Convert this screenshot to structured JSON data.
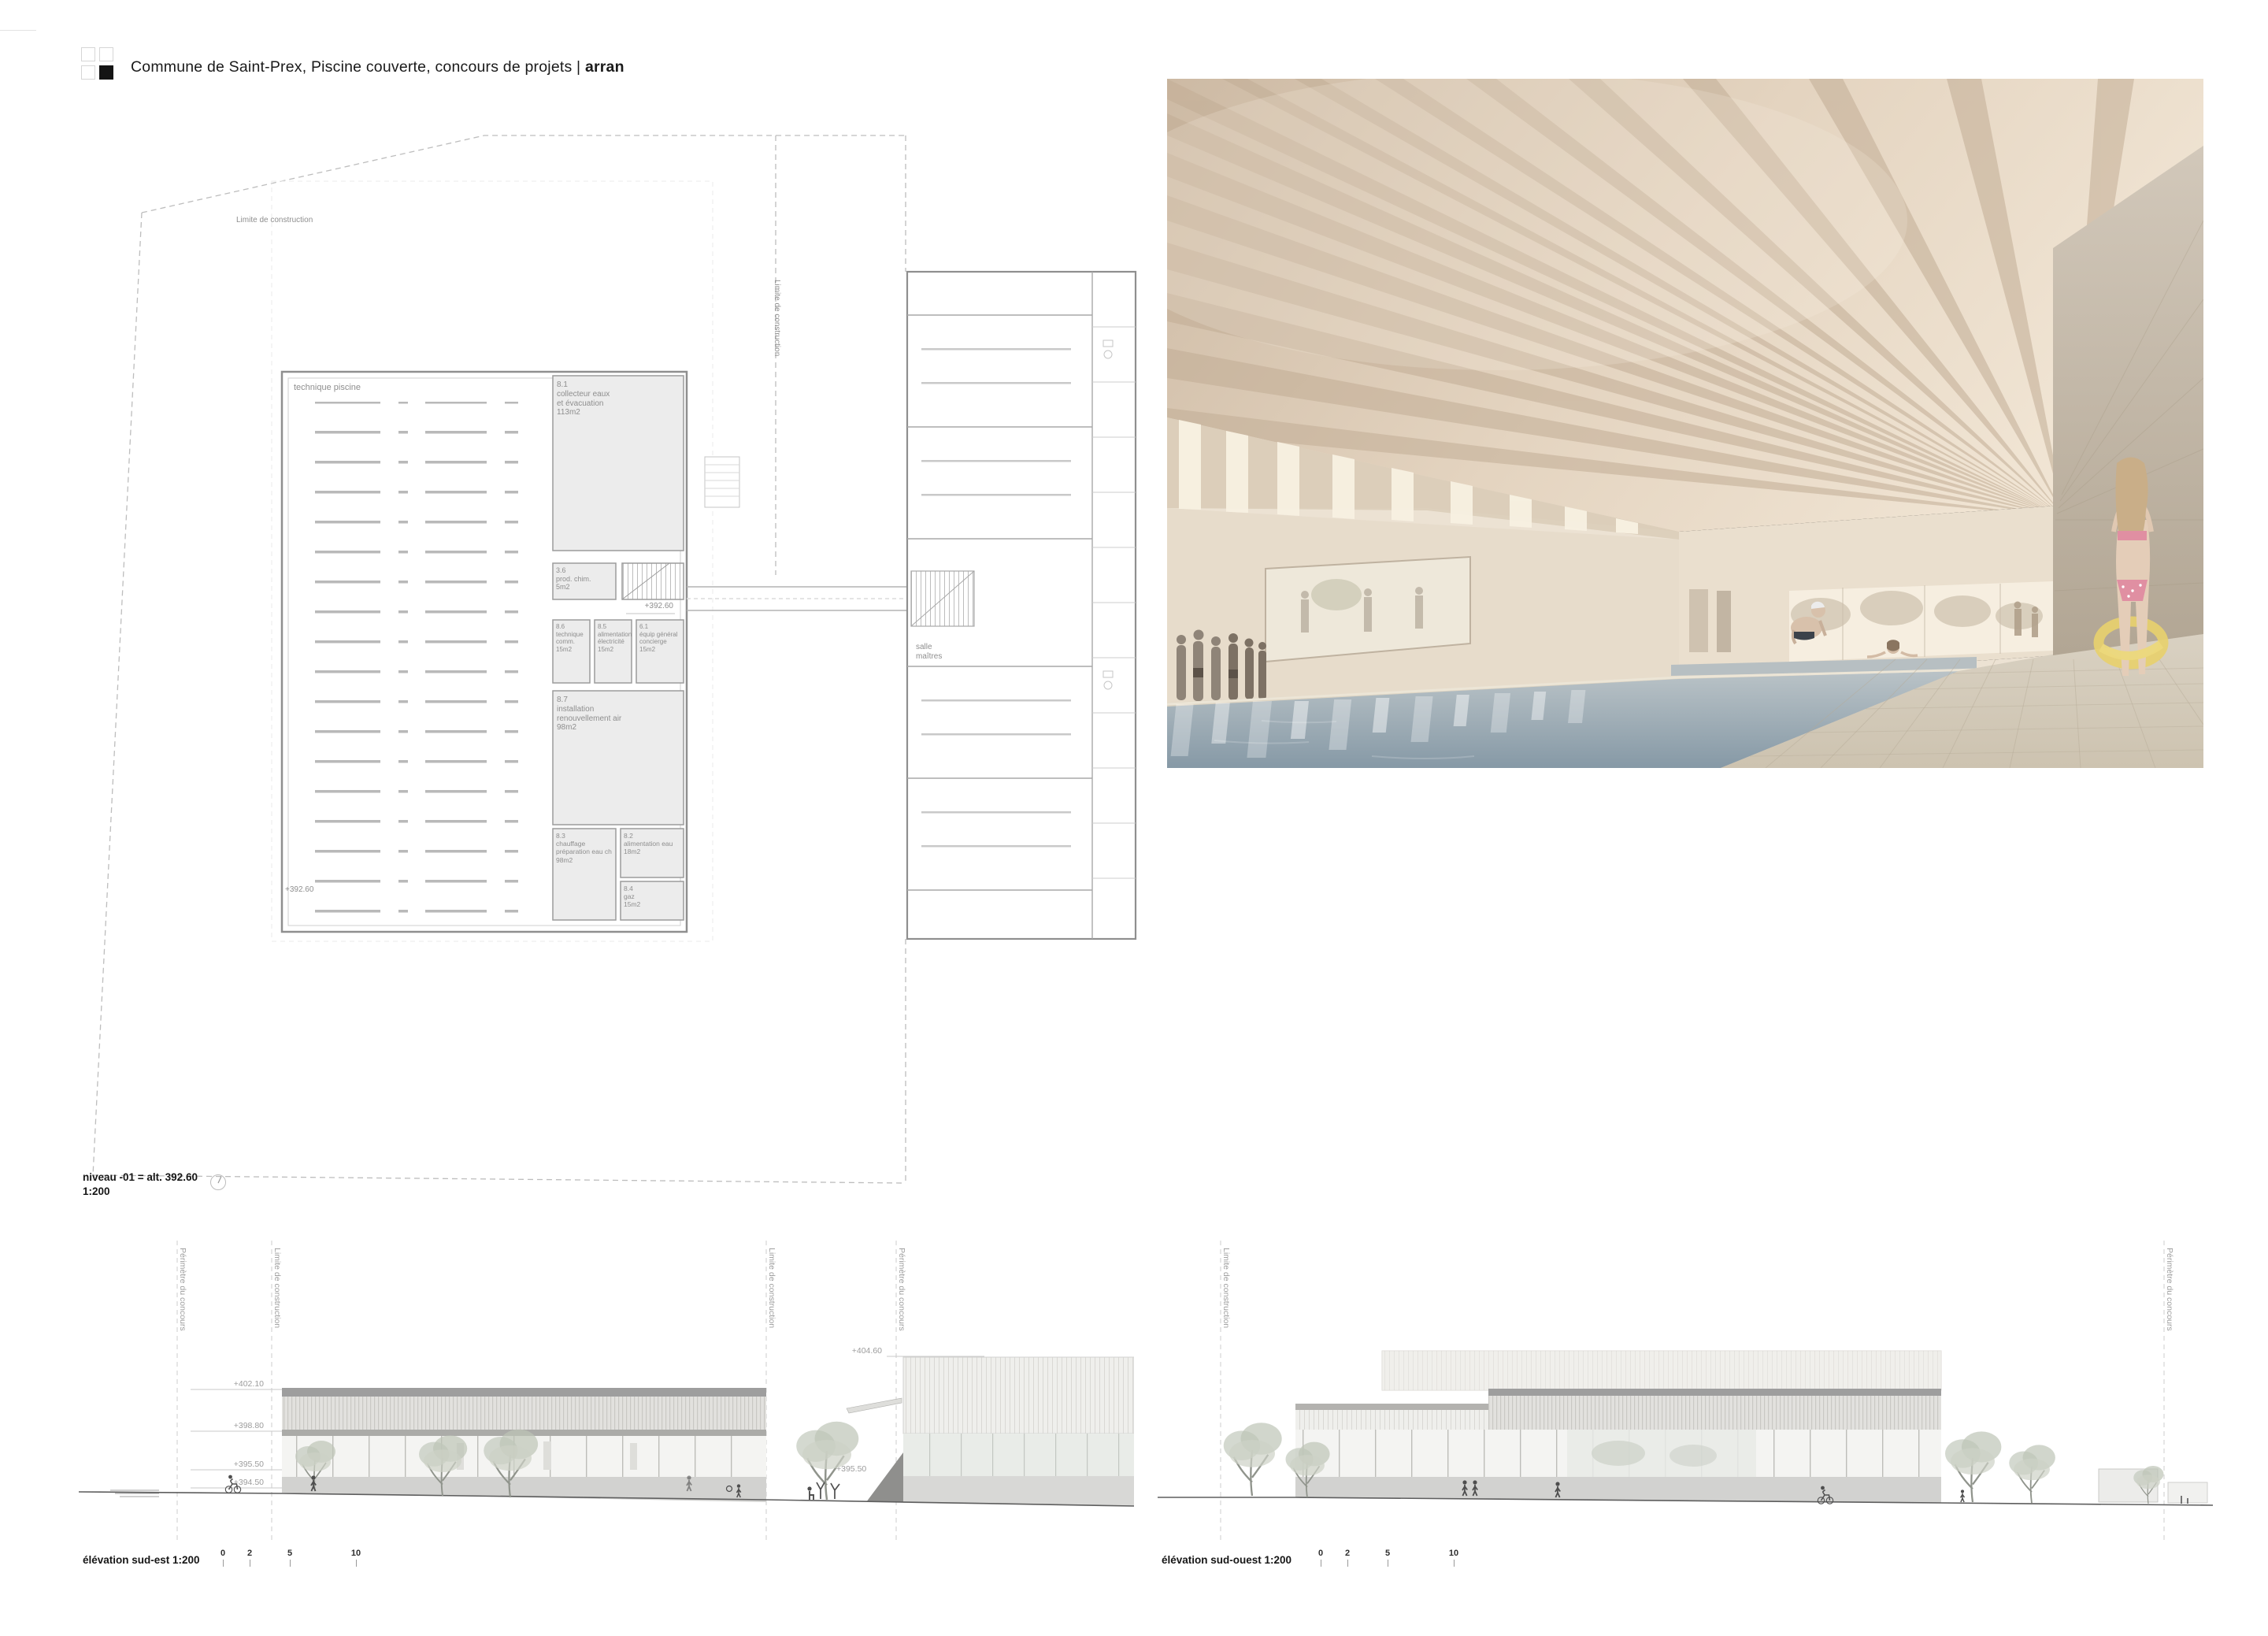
{
  "header": {
    "title_main": "Commune de Saint-Prex, Piscine couverte, concours de projets | ",
    "title_bold": "arran"
  },
  "plan": {
    "boundary_label_top": "Limite de construction",
    "boundary_label_right": "Limite de construction",
    "hall_label": "technique piscine",
    "level_marker_top": "+392.60",
    "level_marker_bottom": "+392.60",
    "salle_label": "salle\nmaîtres",
    "rooms": [
      {
        "id": "8.1",
        "label": "8.1\ncollecteur eaux\net évacuation\n113m2"
      },
      {
        "id": "3.6",
        "label": "3.6\nprod. chim.\n5m2"
      },
      {
        "id": "8.6",
        "label": "8.6\ntechnique\ncomm.\n15m2"
      },
      {
        "id": "8.5",
        "label": "8.5\nalimentation\nélectricité\n15m2"
      },
      {
        "id": "6.1",
        "label": "6.1\néquip général\nconcierge\n15m2"
      },
      {
        "id": "8.7",
        "label": "8.7\ninstallation\nrenouvellement air\n98m2"
      },
      {
        "id": "8.3",
        "label": "8.3\nchauffage\npréparation eau ch\n98m2"
      },
      {
        "id": "8.2",
        "label": "8.2\nalimentation eau\n18m2"
      },
      {
        "id": "8.4",
        "label": "8.4\ngaz\n15m2"
      }
    ],
    "caption_line1": "niveau -01 = alt. 392.60",
    "caption_line2": "1:200"
  },
  "elevations": {
    "sud_est": {
      "caption": "élévation sud-est 1:200",
      "scale_ticks": [
        "0",
        "2",
        "5",
        "10"
      ],
      "guides": [
        "Périmètre du concours",
        "Limite de construction",
        "Limite de construction",
        "Périmètre du concours"
      ],
      "levels": [
        "+402.10",
        "+398.80",
        "+395.50",
        "+394.50",
        "+404.60",
        "+395.50",
        "+393.80"
      ]
    },
    "sud_ouest": {
      "caption": "élévation sud-ouest 1:200",
      "scale_ticks": [
        "0",
        "2",
        "5",
        "10"
      ],
      "guides": [
        "Limite de construction",
        "Périmètre du concours"
      ]
    }
  },
  "colors": {
    "paper": "#ffffff",
    "ink": "#1a1a1a",
    "plan_gray": "#8e8e8e",
    "line_light": "#c9c9c9",
    "water": "#9fadb8",
    "wood": "#cfbca6",
    "deck": "#d5ccbc",
    "ring_yellow": "#e7d06e",
    "bikini_pink": "#e08fa2"
  }
}
